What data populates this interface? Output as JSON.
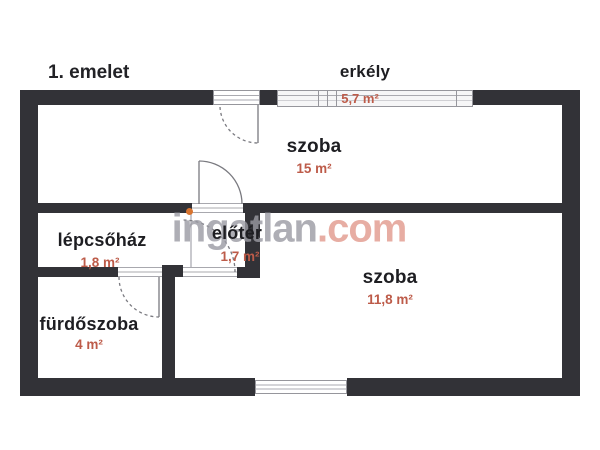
{
  "floor_label": "1. emelet",
  "watermark": {
    "name": "ingatlan",
    "suffix": ".com"
  },
  "rooms": [
    {
      "id": "erkely",
      "name": "erkély",
      "area": "5,7 m²"
    },
    {
      "id": "szoba-top",
      "name": "szoba",
      "area": "15 m²"
    },
    {
      "id": "lepcsohaz",
      "name": "lépcsőház",
      "area": "1,8 m²"
    },
    {
      "id": "eloter",
      "name": "előtér",
      "area": "1,7 m²"
    },
    {
      "id": "furdoszoba",
      "name": "fürdőszoba",
      "area": "4 m²"
    },
    {
      "id": "szoba-bottom",
      "name": "szoba",
      "area": "11,8 m²"
    }
  ],
  "colors": {
    "wall": "#323237",
    "room_label": "#1e1e22",
    "area_label": "#bd5b49",
    "watermark_text": "#9b9ba3",
    "watermark_suffix": "#e2998d",
    "watermark_dot": "#d8742f",
    "background": "#ffffff"
  }
}
